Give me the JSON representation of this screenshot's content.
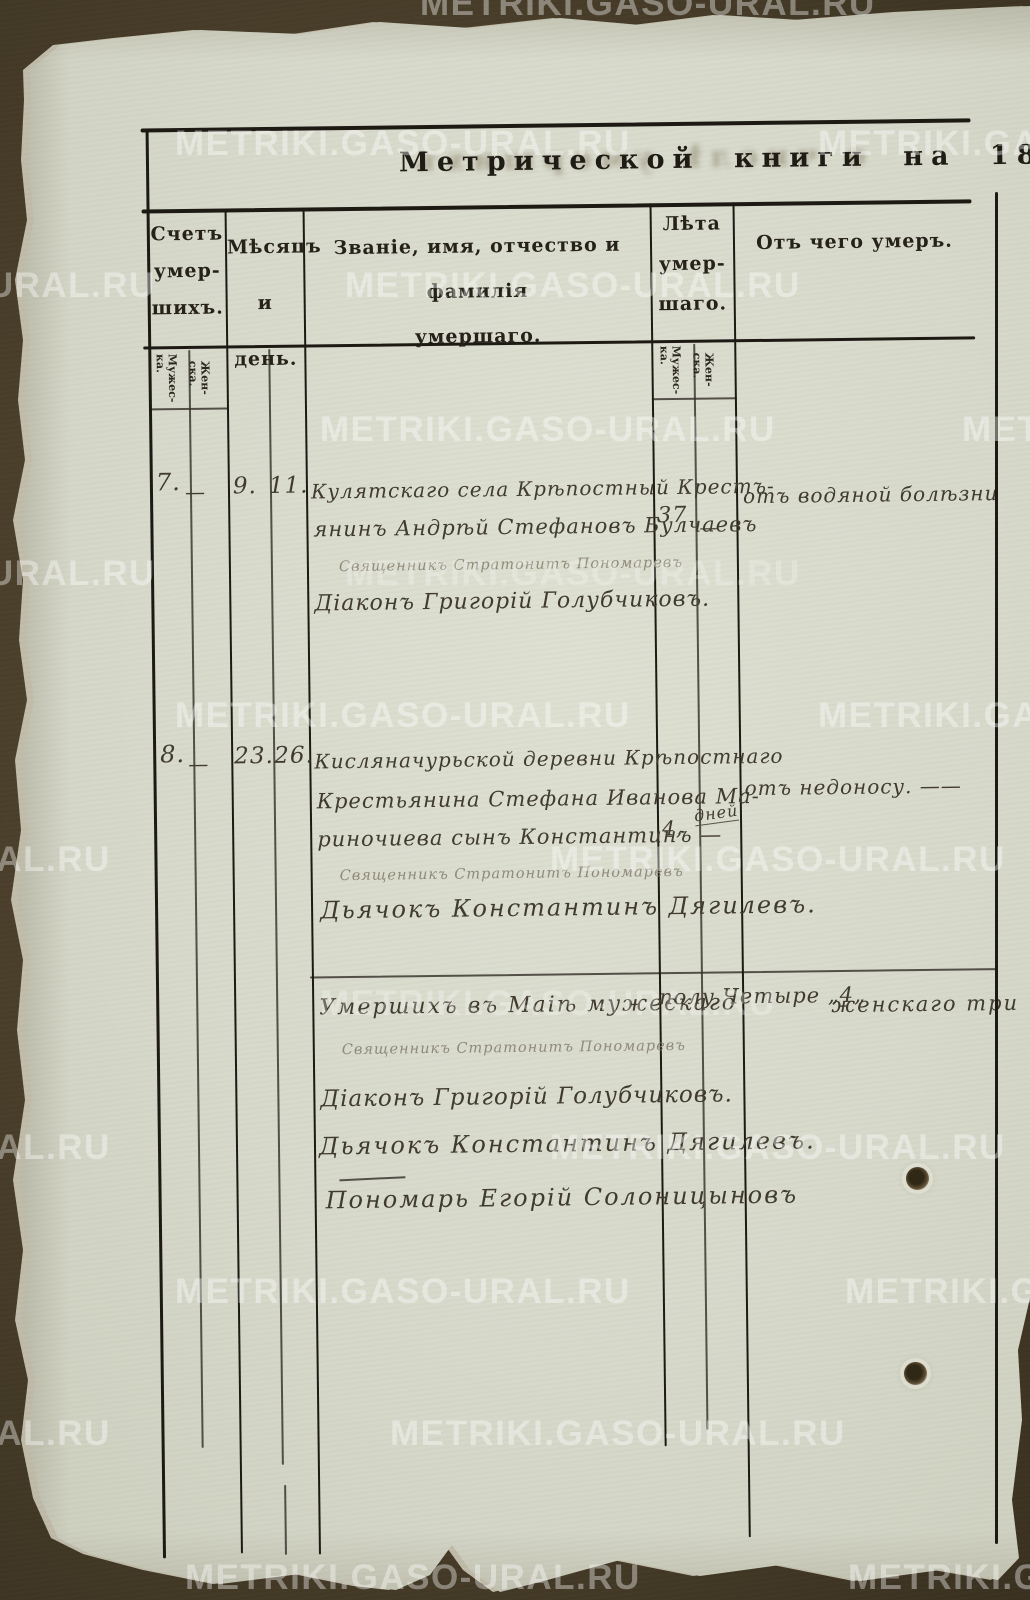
{
  "watermark": {
    "text": "METRIKI.GASO-URAL.RU"
  },
  "title": {
    "printed": "Метрической книги на 18",
    "year_handwritten": "44"
  },
  "bleedthrough_ghost_text": "о числѣ умершихъ",
  "table": {
    "header": {
      "count_lines": [
        "Счетъ",
        "умер-",
        "шихъ."
      ],
      "month_day_lines": [
        "Мѣсяцъ",
        "и день."
      ],
      "name_lines": [
        "Званіе, имя, отчество и фамилія",
        "умершаго."
      ],
      "age_lines": [
        "Лѣта",
        "умер-",
        "шаго."
      ],
      "cause": "Отъ чего умеръ."
    },
    "gender_labels": {
      "male_1": "Мужес-",
      "male_2": "ка.",
      "female_1": "Жен-",
      "female_2": "ска."
    }
  },
  "entries": [
    {
      "count_male": "7.",
      "count_female": "—",
      "month": "9.",
      "day": "11.",
      "name_lines": [
        "Кулятскаго села Крѣпостный Крестъ-",
        "янинъ Андрѣй Стефановъ Булчаевъ"
      ],
      "clergy_lines": [
        "Священникъ Стратонитъ Пономаревъ",
        "Діаконъ Григорій Голубчиковъ."
      ],
      "age_male": "37",
      "age_female": "—",
      "cause": "отъ водяной болѣзни"
    },
    {
      "count_male": "8.",
      "count_female": "—",
      "month": "23.",
      "day": "26.",
      "name_lines": [
        "Кисляначурьской деревни Крѣпостнаго",
        "Крестьянина Стефана Иванова Ма-",
        "риночиева сынъ Константинъ —"
      ],
      "clergy_lines": [
        "Священникъ Стратонитъ Пономаревъ",
        "Дьячокъ Константинъ Дягилевъ."
      ],
      "age_male": "4,",
      "age_female": "дней",
      "cause": "отъ недоносу. ——"
    }
  ],
  "summary": {
    "line_left": "Умершихъ въ Маіѣ мужескаго",
    "line_mid": "полу Четыре „4„",
    "line_right": "женскаго три",
    "clergy_faded": "Священникъ Стратонитъ Пономаревъ",
    "deacon": "Діаконъ Григорій Голубчиковъ.",
    "dyachok": "Дьячокъ Константинъ Дягилевъ.",
    "ponomar": "Пономарь Егорій Солоницыновъ"
  }
}
